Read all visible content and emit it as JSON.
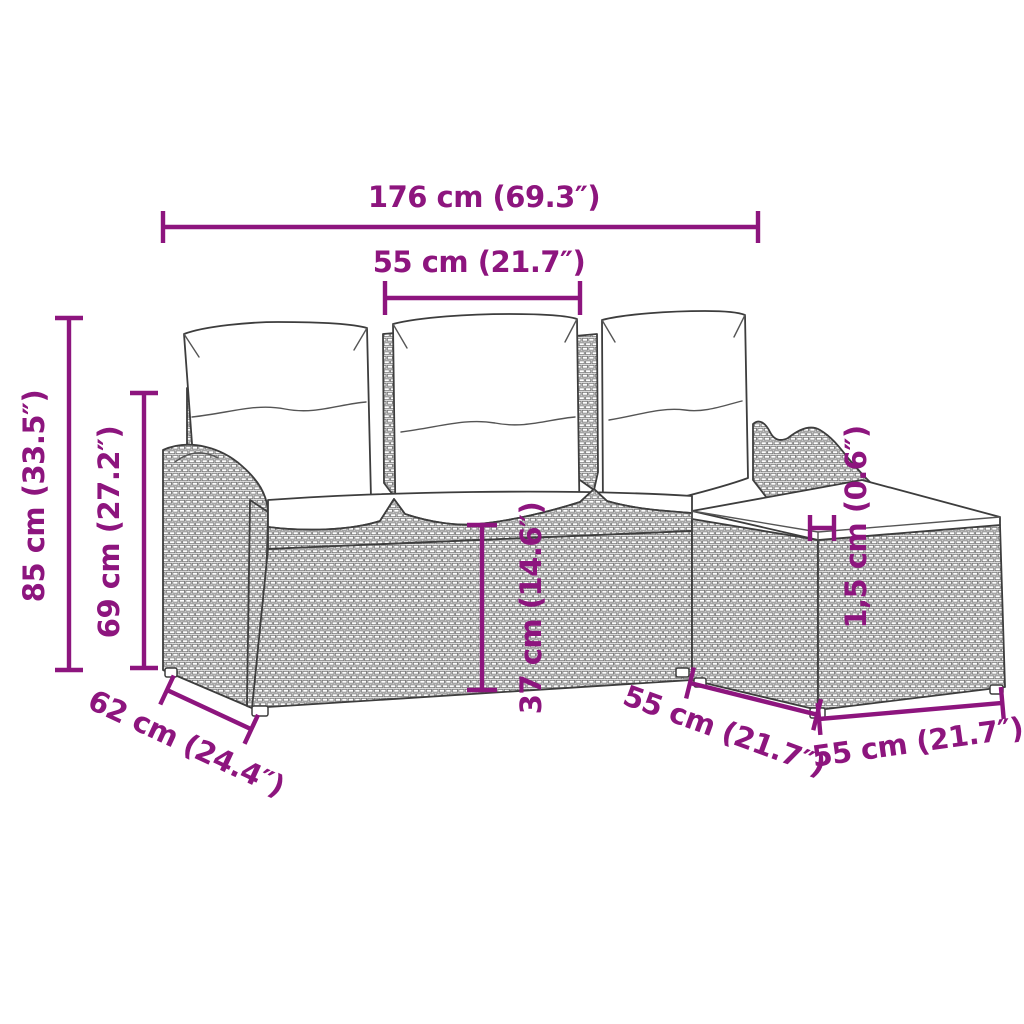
{
  "page": {
    "background": "#ffffff",
    "title": "Garden sofa set dimension diagram"
  },
  "diagram": {
    "type": "product-dimension-diagram",
    "subject": "Poly rattan garden lounge set: 3-seater sofa with back and seat cushions plus footstool with cushion",
    "style": {
      "dimension_color": "#8D157E",
      "outline_color": "#3d3d3d",
      "background": "#ffffff"
    },
    "dimensions": {
      "overall_width": {
        "label": "176 cm (69.3″)",
        "cm": "176",
        "inches": "69.3"
      },
      "seat_width": {
        "label": "55 cm (21.7″)",
        "cm": "55",
        "inches": "21.7"
      },
      "overall_height": {
        "label": "85 cm (33.5″)",
        "cm": "85",
        "inches": "33.5"
      },
      "back_height": {
        "label": "69 cm (27.2″)",
        "cm": "69",
        "inches": "27.2"
      },
      "seat_front_height": {
        "label": "37 cm (14.6″)",
        "cm": "37",
        "inches": "14.6"
      },
      "cushion_thickness": {
        "label": "1,5 cm (0.6″)",
        "cm": "1,5",
        "inches": "0.6"
      },
      "sofa_depth": {
        "label": "62 cm (24.4″)",
        "cm": "62",
        "inches": "24.4"
      },
      "stool_depth": {
        "label": "55 cm (21.7″)",
        "cm": "55",
        "inches": "21.7"
      },
      "stool_front_width": {
        "label": "55 cm (21.7″)",
        "cm": "55",
        "inches": "21.7"
      }
    }
  }
}
